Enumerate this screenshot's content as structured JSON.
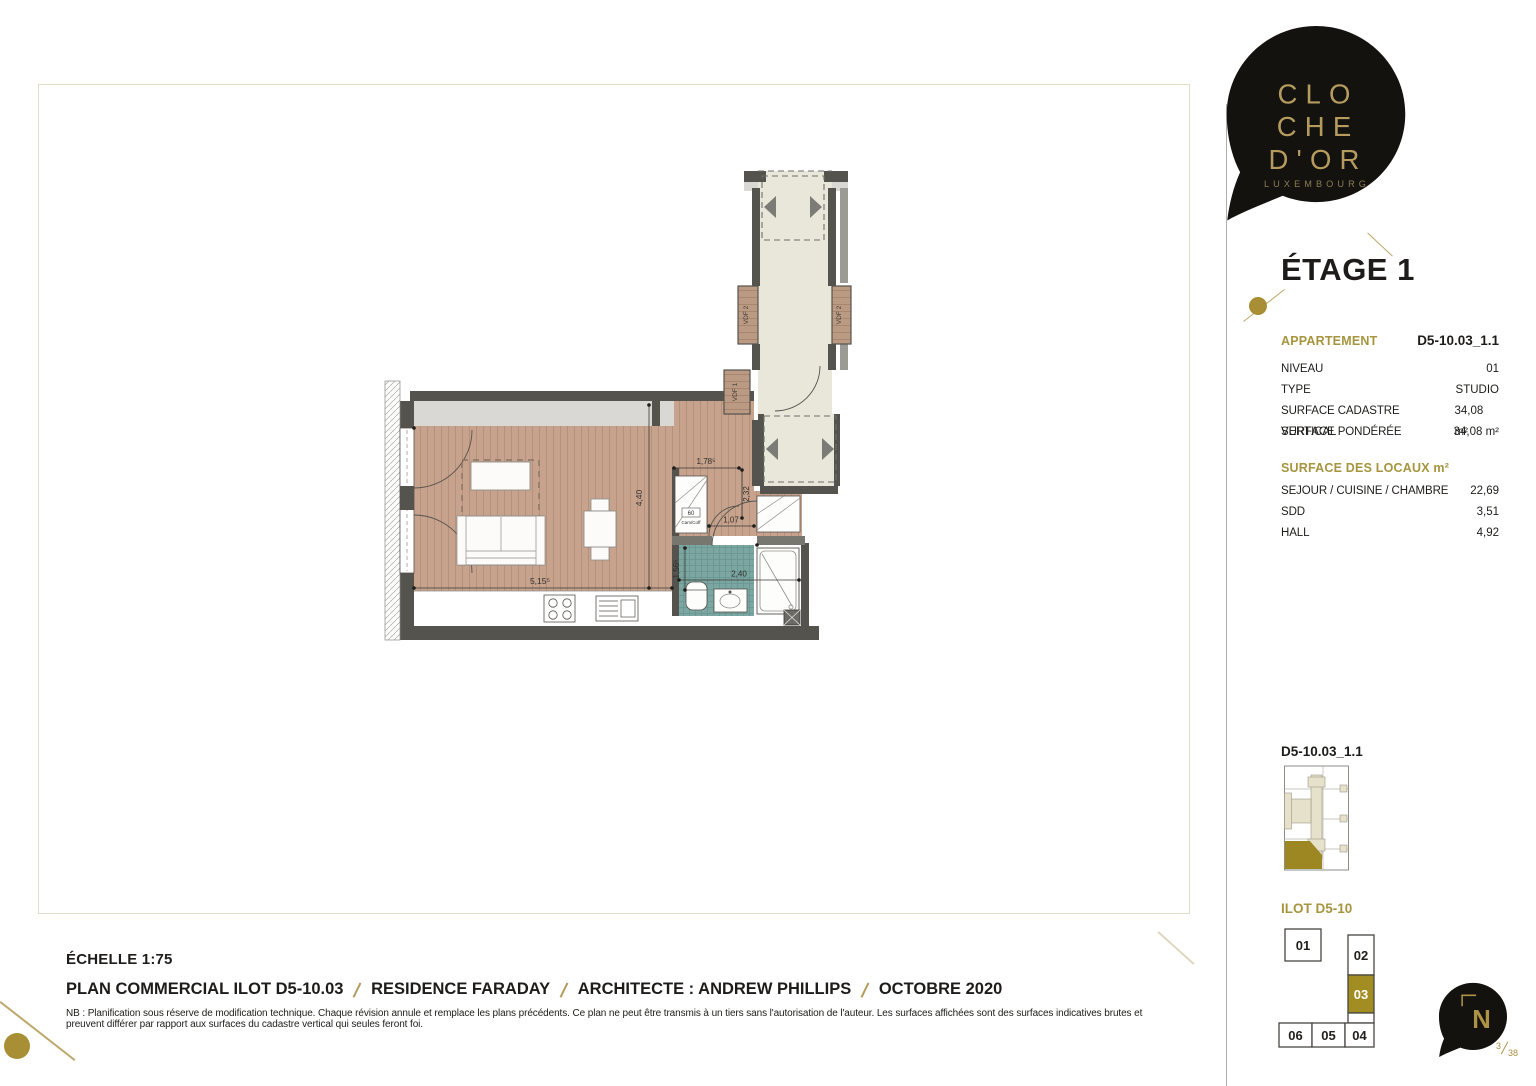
{
  "logo": {
    "line1": "CLO",
    "line2": "CHE",
    "line3": "D'OR",
    "subtitle": "LUXEMBOURG"
  },
  "floor_title": "ÉTAGE 1",
  "apartment": {
    "section_label": "APPARTEMENT",
    "id": "D5-10.03_1.1",
    "rows": [
      {
        "label": "NIVEAU",
        "value": "01"
      },
      {
        "label": "TYPE",
        "value": "STUDIO"
      },
      {
        "label": "SURFACE CADASTRE VERTICAL",
        "value": "34,08 m²"
      },
      {
        "label": "SURFACE PONDÉRÉE",
        "value": "34,08 m²"
      }
    ]
  },
  "surfaces": {
    "title": "SURFACE DES LOCAUX m²",
    "rows": [
      {
        "label": "SEJOUR / CUISINE / CHAMBRE",
        "value": "22,69"
      },
      {
        "label": "SDD",
        "value": "3,51"
      },
      {
        "label": "HALL",
        "value": "4,92"
      }
    ]
  },
  "mini_plan": {
    "title": "D5-10.03_1.1"
  },
  "ilot": {
    "title": "ILOT D5-10",
    "units": {
      "u01": "01",
      "u02": "02",
      "u03": "03",
      "u04": "04",
      "u05": "05",
      "u06": "06"
    },
    "highlighted": "03"
  },
  "north_label": "N",
  "page_number": {
    "numerator": "3",
    "denominator": "38"
  },
  "plan": {
    "dim_living_width": "5,15⁵",
    "dim_living_height": "4,40",
    "dim_hall_width": "1,78⁵",
    "dim_hall_height": "2,32",
    "dim_closet_width": "1,07",
    "dim_sdd_height": "1,56⁵",
    "dim_sdd_width": "2,40",
    "vdf1": "VDF 1",
    "vdf2_left": "VDF 2",
    "vdf2_right": "VDF 2",
    "closet_code": "60",
    "closet_label": "Cam/Coff"
  },
  "footer": {
    "scale": "ÉCHELLE 1:75",
    "segments": [
      "PLAN COMMERCIAL ILOT D5-10.03",
      "RESIDENCE FARADAY",
      "ARCHITECTE : ANDREW PHILLIPS",
      "OCTOBRE 2020"
    ],
    "disclaimer": "NB : Planification sous réserve de modification technique. Chaque révision annule et remplace les plans précédents. Ce plan ne peut être transmis à un tiers sans l'autorisation de l'auteur. Les surfaces affichées sont des surfaces indicatives brutes et preuvent différer par rapport aux surfaces du cadastre vertical qui seules feront foi."
  },
  "colors": {
    "gold": "#a6953e",
    "gold_light": "#b49b5e",
    "logo_black": "#14120e",
    "wood": "#c7a38d",
    "teal": "#7ba6a1",
    "wall": "#55534e",
    "corridor_beige": "#e9e6da",
    "unit_gold": "#a28d22"
  }
}
